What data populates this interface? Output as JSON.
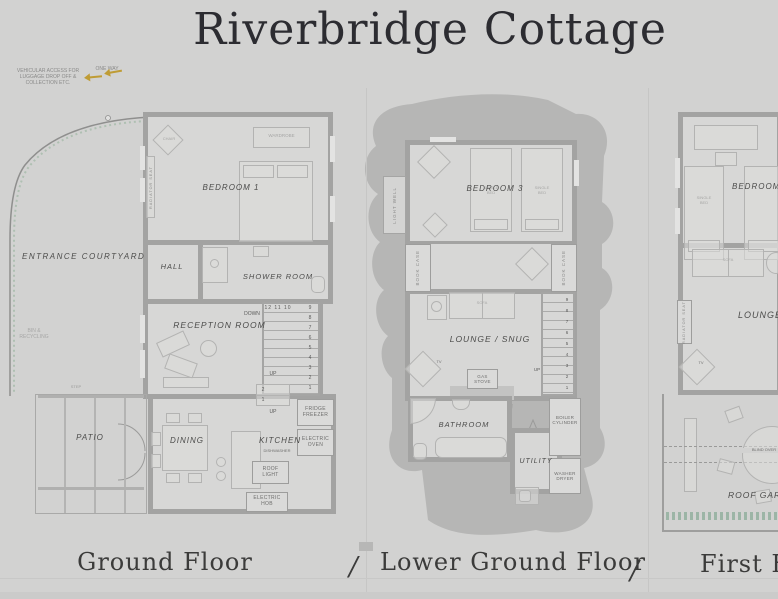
{
  "title": "Riverbridge Cottage",
  "separator": "/",
  "colors": {
    "one_way_arrow": "#bf9c35",
    "planting": "#8fae9b",
    "background": "#d2d2d1",
    "wall": "#a3a3a2"
  },
  "access_note": {
    "text": "VEHICULAR ACCESS FOR\nLUGGAGE DROP OFF &\nCOLLECTION ETC.",
    "one_way": "ONE WAY"
  },
  "ground": {
    "label": "Ground Floor",
    "entrance_courtyard": "ENTRANCE COURTYARD",
    "bin_recycling": "BIN &\nRECYCLING",
    "bedroom1": "BEDROOM 1",
    "wardrobe": "WARDROBE",
    "chair": "CHAIR",
    "radiator_seat": "RADIATOR SEAT",
    "hall": "HALL",
    "shower_room": "SHOWER ROOM",
    "reception_room": "RECEPTION ROOM",
    "stairs_top_row": "12 11 10",
    "stairs_down": "DOWN",
    "stairs_column": "9\n8\n7\n6\n5\n4\n3\n2\n1",
    "stairs_up": "UP",
    "kitchen_steps": "2\n1",
    "kitchen_steps_up": "UP",
    "patio": "PATIO",
    "step": "STEP",
    "dining": "DINING",
    "kitchen": "KITCHEN",
    "fridge_freezer": "FRIDGE\nFREEZER",
    "electric_oven": "ELECTRIC\nOVEN",
    "dishwasher": "DISHWASHER",
    "roof_light": "ROOF\nLIGHT",
    "electric_hob": "ELECTRIC\nHOB"
  },
  "lower": {
    "label": "Lower Ground Floor",
    "bedroom3": "BEDROOM 3",
    "single_bed": "SINGLE\nBED",
    "light_well": "LIGHT WELL",
    "book_case": "BOOK CASE",
    "lounge_snug": "LOUNGE / SNUG",
    "sofa": "SOFA",
    "tv": "TV",
    "gas_stove": "GAS\nSTOVE",
    "stairs_column": "9\n8\n7\n6\n5\n4\n3\n2\n1",
    "stairs_up": "UP",
    "bathroom": "BATHROOM",
    "utility": "UTILITY",
    "boiler_cylinder": "BOILER\nCYLINDER",
    "washer_dryer": "WASHER\nDRYER"
  },
  "first": {
    "label": "First Floor",
    "bedroom2": "BEDROOM 2",
    "single_bed": "SINGLE\nBED",
    "sofa": "SOFA",
    "lounge": "LOUNGE",
    "radiator_seat": "RADIATOR SEAT",
    "tv": "TV",
    "roof_garden": "ROOF GARDEN",
    "blind_over": "BLIND OVER"
  }
}
